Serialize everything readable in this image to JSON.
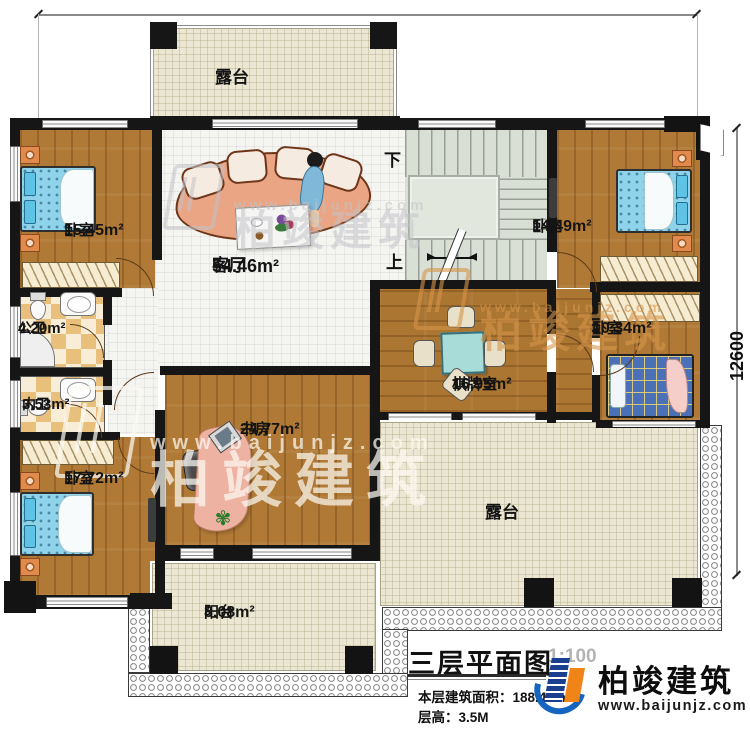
{
  "titleblock": {
    "title": "三层平面图",
    "scale": "1:100",
    "area_line": "本层建筑面积：188.41m²",
    "floor_height_line": "层高：3.5M"
  },
  "brand": {
    "name": "柏竣建筑",
    "url": "www.baijunjz.com"
  },
  "dimensions": {
    "right": "12600"
  },
  "stairs": {
    "down": "下",
    "up": "上"
  },
  "rooms": [
    {
      "id": "terrace-top",
      "label": "露台",
      "area": ""
    },
    {
      "id": "bedroom-top-left",
      "label": "卧室",
      "area": "15.45m²"
    },
    {
      "id": "living-room",
      "label": "客厅",
      "area": "54.46m²"
    },
    {
      "id": "public-bathroom",
      "label": "公卫",
      "area": "4.20m²"
    },
    {
      "id": "private-bathroom",
      "label": "内卫",
      "area": "3.53m²"
    },
    {
      "id": "bedroom-bottom-left",
      "label": "卧室",
      "area": "17.72m²"
    },
    {
      "id": "study",
      "label": "书房",
      "area": "24.77m²"
    },
    {
      "id": "game-room",
      "label": "棋牌室",
      "area": "16.95m²"
    },
    {
      "id": "bedroom-top-right",
      "label": "卧室",
      "area": "14.49m²"
    },
    {
      "id": "bedroom-right",
      "label": "卧室",
      "area": "10.34m²"
    },
    {
      "id": "terrace-bottom",
      "label": "露台",
      "area": ""
    },
    {
      "id": "balcony",
      "label": "阳台",
      "area": "8.08m²"
    }
  ],
  "colors": {
    "wall": "#161616",
    "wood": "#b07a36",
    "terrace_floor": "#ebe7d2",
    "bed": "#8ed3ea",
    "logo_blue": "#1565c0",
    "logo_orange": "#f08418"
  }
}
